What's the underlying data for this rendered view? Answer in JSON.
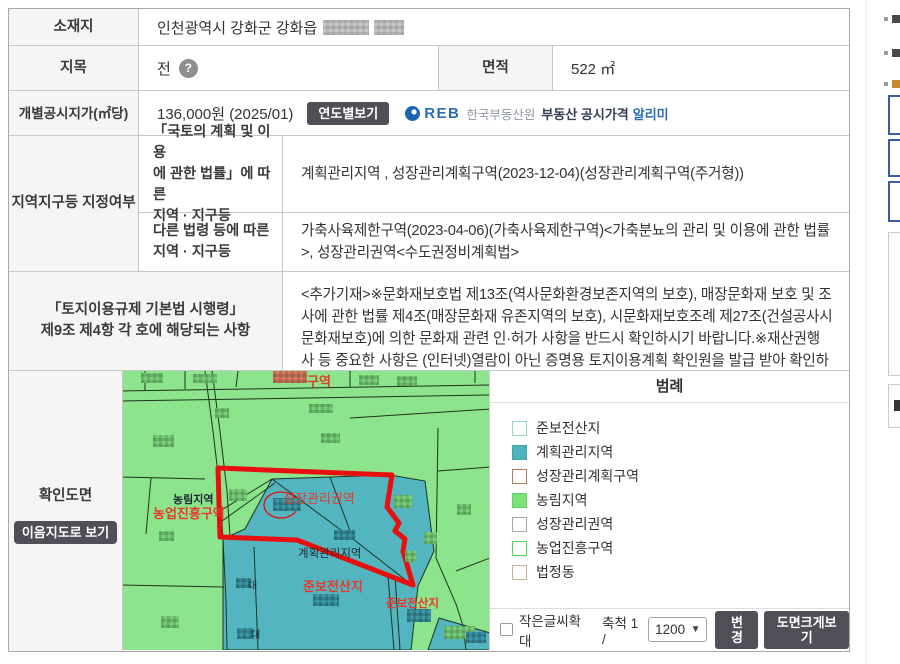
{
  "colors": {
    "line": "#c8c8c8",
    "outer": "#a9a9a9",
    "head": "#f5f5f4",
    "text": "#333333",
    "btn-dark": "#4e4f57",
    "map-green": "#8ce48c",
    "map-teal": "#52b5c0",
    "map-line": "#1e3320",
    "map-red": "#e80f0f",
    "label-red": "#e8392a",
    "reb-blue": "#2a6cb5",
    "frag-blue": "#3d5c9e"
  },
  "table": {
    "location": {
      "label": "소재지",
      "value": "인천광역시 강화군 강화읍"
    },
    "category": {
      "label": "지목",
      "value": "전",
      "help_icon": "question-icon"
    },
    "area": {
      "label": "면적",
      "value": "522 ㎡"
    },
    "price": {
      "label": "개별공시지가(㎡당)",
      "value": "136,000원 (2025/01)",
      "year_button": "연도별보기",
      "reb": {
        "logo": "REB",
        "org": "한국부동산원",
        "service": "부동산 공시가격",
        "service_suffix": "알리미"
      }
    },
    "zones": {
      "label": "지역지구등 지정여부",
      "national": {
        "label_lines": [
          "「국토의 계획 및 이용",
          "에 관한 법률」에 따른",
          "지역 · 지구등"
        ],
        "value": "계획관리지역 , 성장관리계획구역(2023-12-04)(성장관리계획구역(주거형))"
      },
      "other": {
        "label_lines": [
          "다른 법령 등에 따른",
          "지역 · 지구등"
        ],
        "value": "가축사육제한구역(2023-04-06)(가축사육제한구역)<가축분뇨의 관리 및 이용에 관한 법률>, 성장관리권역<수도권정비계획법>"
      }
    },
    "regulation": {
      "label_lines": [
        "「토지이용규제 기본법 시행령」",
        "제9조 제4항 각 호에 해당되는 사항"
      ],
      "value": "<추가기재>※문화재보호법 제13조(역사문화환경보존지역의 보호), 매장문화재 보호 및 조사에 관한 법률 제4조(매장문화재 유존지역의 보호), 시문화재보호조례 제27조(건설공사시 문화재보호)에 의한 문화재 관련 인·허가 사항을 반드시 확인하시기 바랍니다.※재산권행사 등 중요한 사항은 (인터넷)열람이 아닌 증명용 토지이용계획 확인원을 발급 받아 확인하시기 바랍니다."
    },
    "drawing": {
      "label": "확인도면",
      "map_button": "이음지도로 보기"
    }
  },
  "map": {
    "labels": [
      {
        "text": "구역",
        "color": "red"
      },
      {
        "text": "농림지역",
        "color": "dark"
      },
      {
        "text": "농업진흥구역",
        "color": "red"
      },
      {
        "text": "성장관리권역",
        "color": "red"
      },
      {
        "text": "계획관리지역",
        "color": "dark"
      },
      {
        "text": "준보전산지",
        "color": "red"
      },
      {
        "text": "준보전산지",
        "color": "red"
      },
      {
        "text": "대",
        "color": "dark"
      },
      {
        "text": "대",
        "color": "dark"
      }
    ]
  },
  "legend": {
    "title": "범례",
    "items": [
      {
        "label": "준보전산지",
        "fill": "#ffffff",
        "border": "#96d7c8"
      },
      {
        "label": "계획관리지역",
        "fill": "#4db2bc",
        "border": "#40a5af"
      },
      {
        "label": "성장관리계획구역",
        "fill": "#ffffff",
        "border": "#b07a5e"
      },
      {
        "label": "농림지역",
        "fill": "#79e279",
        "border": "#68d168"
      },
      {
        "label": "성장관리권역",
        "fill": "#ffffff",
        "border": "#a6a6a6"
      },
      {
        "label": "농업진흥구역",
        "fill": "#ffffff",
        "border": "#52d552"
      },
      {
        "label": "법정동",
        "fill": "#ffffff",
        "border": "#c6b493"
      }
    ]
  },
  "controls": {
    "small_text_label": "작은글씨확대",
    "scale_label": "축척 1 /",
    "scale_value": "1200",
    "change_button": "변경",
    "enlarge_button": "도면크게보기"
  }
}
